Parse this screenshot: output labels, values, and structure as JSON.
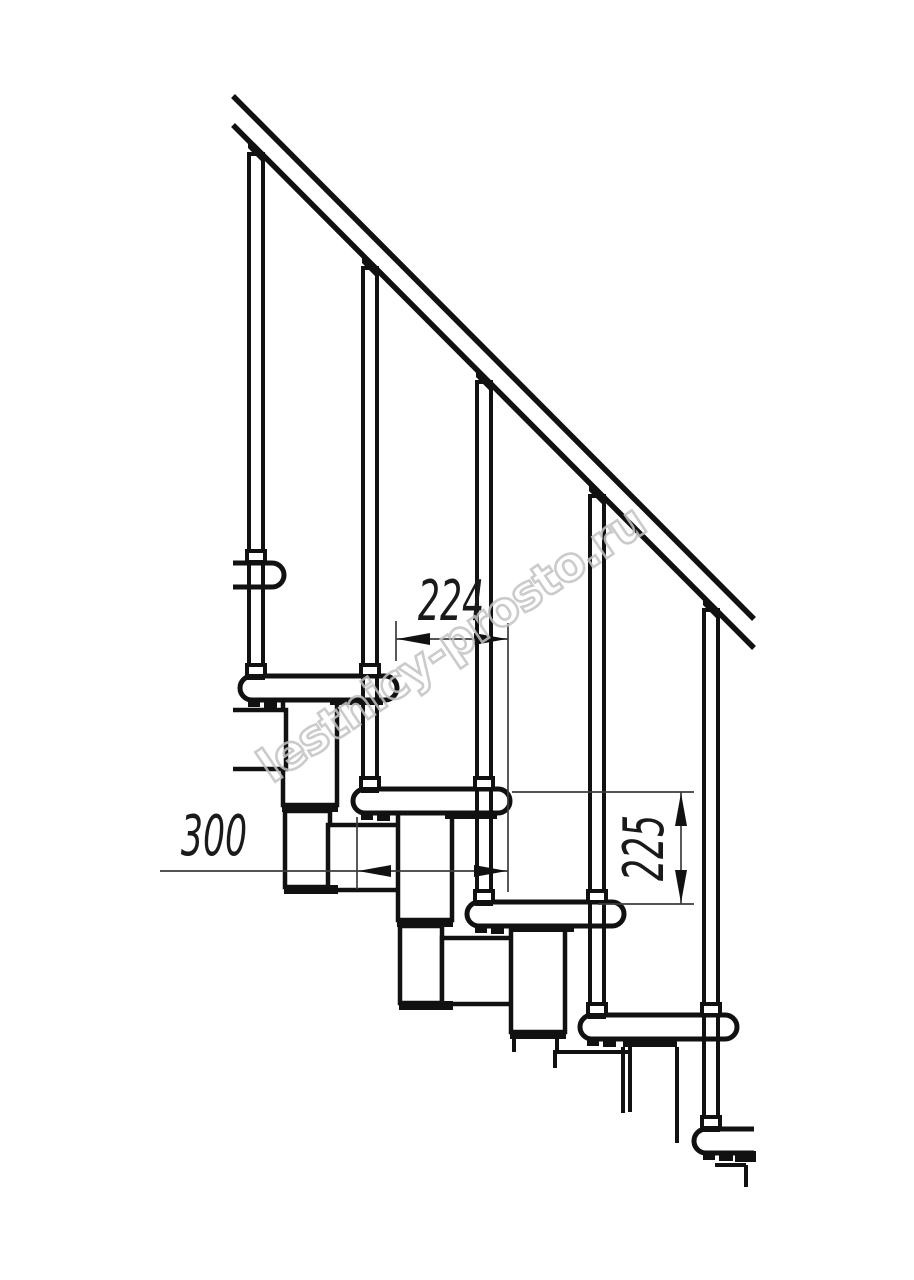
{
  "drawing": {
    "kind": "staircase-side-elevation-technical-drawing",
    "watermark_text": "lestnicy-prosto.ru",
    "dimensions": {
      "step_run": "224",
      "tread_depth": "300",
      "riser_height": "225"
    },
    "counts": {
      "balusters_visible": "5",
      "treads_visible": "6"
    },
    "colors": {
      "line": "#111111",
      "dim_line": "#3c3c3c",
      "watermark": "#c3c3c3",
      "background": "#ffffff"
    }
  }
}
